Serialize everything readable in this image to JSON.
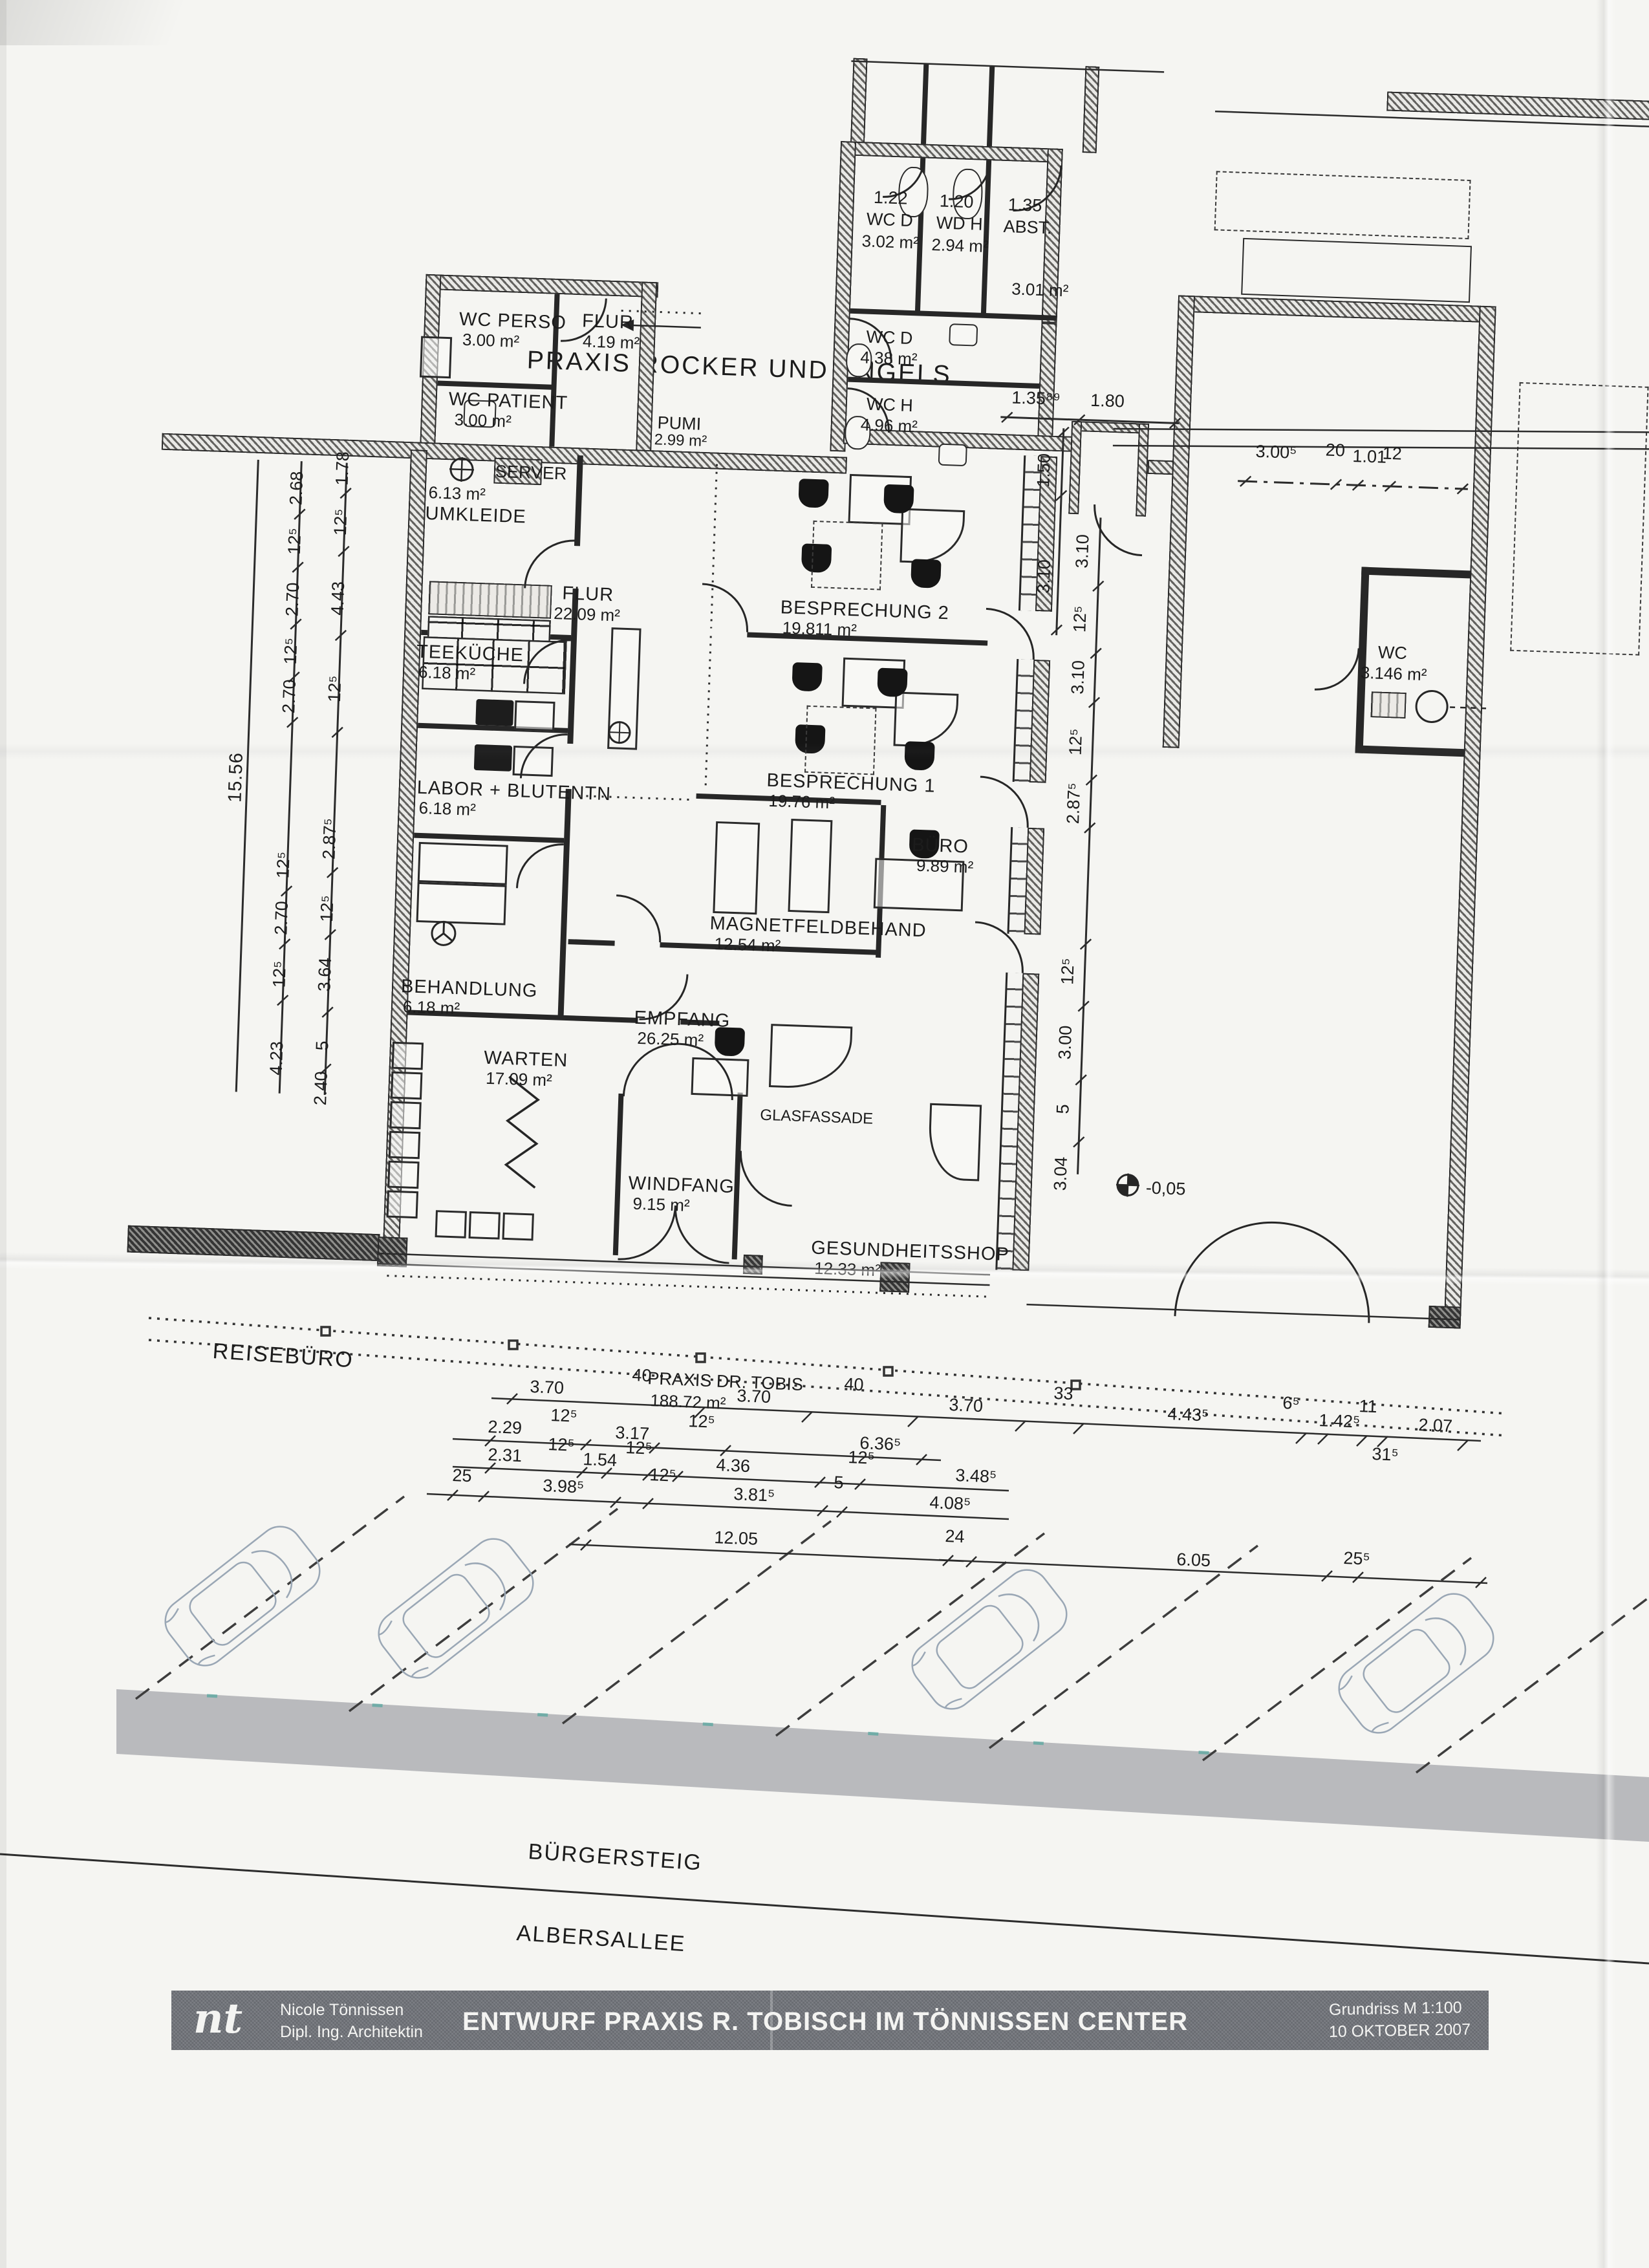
{
  "title": "PRAXIS ROCKER UND ENGELS",
  "rooms": {
    "wc_perso": {
      "name": "WC PERSO",
      "area": "3.00 m²"
    },
    "flur_klein": {
      "name": "FLUR",
      "area": "4.19 m²"
    },
    "wc_patient": {
      "name": "WC PATIENT",
      "area": "3.00 m²"
    },
    "server": {
      "name": "SERVER"
    },
    "umkleide": {
      "name": "UMKLEIDE",
      "area": "6.13 m²"
    },
    "teekueche": {
      "name": "TEEKÜCHE",
      "area": "6.18 m²"
    },
    "labor": {
      "name": "LABOR + BLUTENTN",
      "area": "6.18 m²"
    },
    "behandlung": {
      "name": "BEHANDLUNG",
      "area": "6.18 m²"
    },
    "warten": {
      "name": "WARTEN",
      "area": "17.09 m²"
    },
    "flur_gross": {
      "name": "FLUR",
      "area": "22.09 m²"
    },
    "pumi": {
      "name": "PUMI",
      "area": "2.99 m²"
    },
    "besprechung2": {
      "name": "BESPRECHUNG 2",
      "area": "19.811 m²"
    },
    "besprechung1": {
      "name": "BESPRECHUNG 1",
      "area": "19.76 m²"
    },
    "buero": {
      "name": "BÜRO",
      "area": "9.89 m²"
    },
    "magnetfeld": {
      "name": "MAGNETFELDBEHAND",
      "area": "12.54 m²"
    },
    "empfang": {
      "name": "EMPFANG",
      "area": "26.25 m²"
    },
    "windfang": {
      "name": "WINDFANG",
      "area": "9.15 m²"
    },
    "glasfassade": {
      "name": "GLASFASSADE"
    },
    "gesundheitsshop": {
      "name": "GESUNDHEITSSHOP",
      "area": "12.33 m²"
    },
    "wc_rechts": {
      "name": "WC",
      "area": "3.146 m²"
    },
    "wc_d": {
      "name": "WC D",
      "area": "4.38 m²"
    },
    "wc_h": {
      "name": "WC H",
      "area": "4.96 m²"
    },
    "r122": {
      "num": "1.22",
      "name": "WC D",
      "area": "3.02 m²"
    },
    "r120": {
      "num": "1.20",
      "name": "WD H",
      "area": "2.94 m²"
    },
    "r135": {
      "num": "1.35",
      "name": "ABST.",
      "area": "3.01 m²"
    }
  },
  "dims": {
    "left_outer": "15.56",
    "left_mid": [
      "2.68",
      "12⁵",
      "2.70",
      "12⁵",
      "2.70",
      "12⁵",
      "2.70",
      "12⁵",
      "4.23"
    ],
    "left_in": [
      "1.78",
      "12⁵",
      "4.43",
      "12⁵",
      "2.87⁵",
      "12⁵",
      "3.64",
      "5",
      "2.40"
    ],
    "right": [
      "3.10",
      "12⁵",
      "3.10",
      "12⁵",
      "2.87⁵",
      "12⁵",
      "3.00",
      "5",
      "3.04"
    ],
    "top": [
      "1.35⁸⁹",
      "1.80",
      "1.50",
      "3.10"
    ],
    "top_right": [
      "3.00⁵",
      "20",
      "1.01",
      "12"
    ],
    "row1": [
      "3.70",
      "40",
      "3.70",
      "40",
      "3.70",
      "33",
      "4.43⁵",
      "6⁵",
      "1.42⁵",
      "11",
      "2.07",
      "31⁵"
    ],
    "row2": [
      "2.29",
      "12⁵",
      "3.17",
      "12⁵",
      "6.36⁵"
    ],
    "row3": [
      "2.31",
      "12⁵",
      "1.54",
      "12⁵",
      "4.36",
      "12⁵",
      "3.48⁵"
    ],
    "row4": [
      "25",
      "3.98⁵",
      "12⁵",
      "3.81⁵",
      "5",
      "4.08⁵"
    ],
    "row5": [
      "12.05",
      "24",
      "6.05",
      "25⁵"
    ],
    "level": "-0,05"
  },
  "site": {
    "reiseburo": "REISEBÜRO",
    "praxis_tobis": "PRAXIS DR. TOBIS",
    "praxis_tobis_area": "188.72 m²",
    "buergersteig": "BÜRGERSTEIG",
    "albersallee": "ALBERSALLEE"
  },
  "titleblock": {
    "logo": "nt",
    "name": "Nicole Tönnissen",
    "role": "Dipl. Ing. Architektin",
    "project": "ENTWURF PRAXIS R. TOBISCH IM TÖNNISSEN CENTER",
    "scale": "Grundriss M 1:100",
    "date": "10 OKTOBER 2007"
  }
}
